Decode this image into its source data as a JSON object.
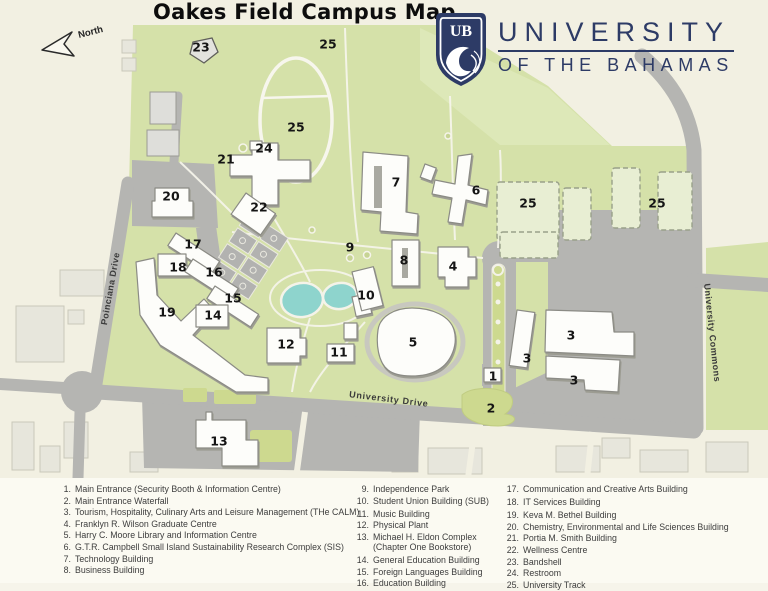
{
  "title": "Oakes Field Campus Map",
  "compass": {
    "label": "North"
  },
  "logo": {
    "initials": "UB",
    "line1": "UNIVERSITY",
    "line2": "OF THE BAHAMAS",
    "navy": "#2d3b66"
  },
  "roads": {
    "poinciana": {
      "name": "Poinciana Drive"
    },
    "university_drive": {
      "name": "University Drive"
    },
    "university_commons": {
      "name": "University Commons"
    }
  },
  "map": {
    "markers": [
      {
        "num": "23",
        "x": 201,
        "y": 47
      },
      {
        "num": "25",
        "x": 328,
        "y": 44
      },
      {
        "num": "25",
        "x": 296,
        "y": 127
      },
      {
        "num": "24",
        "x": 264,
        "y": 148
      },
      {
        "num": "21",
        "x": 226,
        "y": 159
      },
      {
        "num": "20",
        "x": 171,
        "y": 196
      },
      {
        "num": "22",
        "x": 259,
        "y": 207
      },
      {
        "num": "7",
        "x": 396,
        "y": 182
      },
      {
        "num": "6",
        "x": 476,
        "y": 190
      },
      {
        "num": "25",
        "x": 528,
        "y": 203
      },
      {
        "num": "25",
        "x": 657,
        "y": 203
      },
      {
        "num": "17",
        "x": 193,
        "y": 244
      },
      {
        "num": "9",
        "x": 350,
        "y": 247
      },
      {
        "num": "8",
        "x": 404,
        "y": 260
      },
      {
        "num": "4",
        "x": 453,
        "y": 266
      },
      {
        "num": "18",
        "x": 178,
        "y": 267
      },
      {
        "num": "16",
        "x": 214,
        "y": 272
      },
      {
        "num": "10",
        "x": 366,
        "y": 295
      },
      {
        "num": "15",
        "x": 233,
        "y": 298
      },
      {
        "num": "19",
        "x": 167,
        "y": 312
      },
      {
        "num": "14",
        "x": 213,
        "y": 315
      },
      {
        "num": "3",
        "x": 571,
        "y": 335
      },
      {
        "num": "5",
        "x": 413,
        "y": 342
      },
      {
        "num": "12",
        "x": 286,
        "y": 344
      },
      {
        "num": "11",
        "x": 339,
        "y": 352
      },
      {
        "num": "3",
        "x": 527,
        "y": 358
      },
      {
        "num": "1",
        "x": 493,
        "y": 376
      },
      {
        "num": "3",
        "x": 574,
        "y": 380
      },
      {
        "num": "2",
        "x": 491,
        "y": 408
      },
      {
        "num": "13",
        "x": 219,
        "y": 441
      }
    ]
  },
  "legend": {
    "columns": [
      [
        {
          "num": "1.",
          "label": "Main Entrance (Security Booth & Information Centre)"
        },
        {
          "num": "2.",
          "label": "Main Entrance Waterfall"
        },
        {
          "num": "3.",
          "label": "Tourism, Hospitality, Culinary Arts and Leisure Management (THe CALM)"
        },
        {
          "num": "4.",
          "label": "Franklyn R. Wilson Graduate Centre"
        },
        {
          "num": "5.",
          "label": "Harry C. Moore Library and Information Centre"
        },
        {
          "num": "6.",
          "label": "G.T.R. Campbell Small Island Sustainability Research Complex (SIS)"
        },
        {
          "num": "7.",
          "label": "Technology Building"
        },
        {
          "num": "8.",
          "label": "Business Building"
        }
      ],
      [
        {
          "num": "9.",
          "label": "Independence Park"
        },
        {
          "num": "10.",
          "label": "Student Union Building (SUB)"
        },
        {
          "num": "11.",
          "label": "Music Building"
        },
        {
          "num": "12.",
          "label": "Physical Plant"
        },
        {
          "num": "13.",
          "label": "Michael H. Eldon Complex (Chapter One Bookstore)"
        },
        {
          "num": "14.",
          "label": "General Education Building"
        },
        {
          "num": "15.",
          "label": "Foreign Languages Building"
        },
        {
          "num": "16.",
          "label": "Education Building"
        }
      ],
      [
        {
          "num": "17.",
          "label": "Communication and Creative Arts Building"
        },
        {
          "num": "18.",
          "label": "IT Services Building"
        },
        {
          "num": "19.",
          "label": "Keva M. Bethel Building"
        },
        {
          "num": "20.",
          "label": "Chemistry, Environmental and Life Sciences Building"
        },
        {
          "num": "21.",
          "label": "Portia M. Smith Building"
        },
        {
          "num": "22.",
          "label": "Wellness Centre"
        },
        {
          "num": "23.",
          "label": "Bandshell"
        },
        {
          "num": "24.",
          "label": "Restroom"
        },
        {
          "num": "25.",
          "label": "University Track"
        }
      ]
    ]
  },
  "colors": {
    "campus_green": "#d5e1a9",
    "light_green": "#dde8b8",
    "zone_green": "#e8eed3",
    "road_gray": "#b5b5b2",
    "building_white": "#fdfdfa",
    "pond_teal": "#8ed4cd",
    "offmap_beige": "#f2f0e2",
    "logo_navy": "#2d3b66"
  }
}
